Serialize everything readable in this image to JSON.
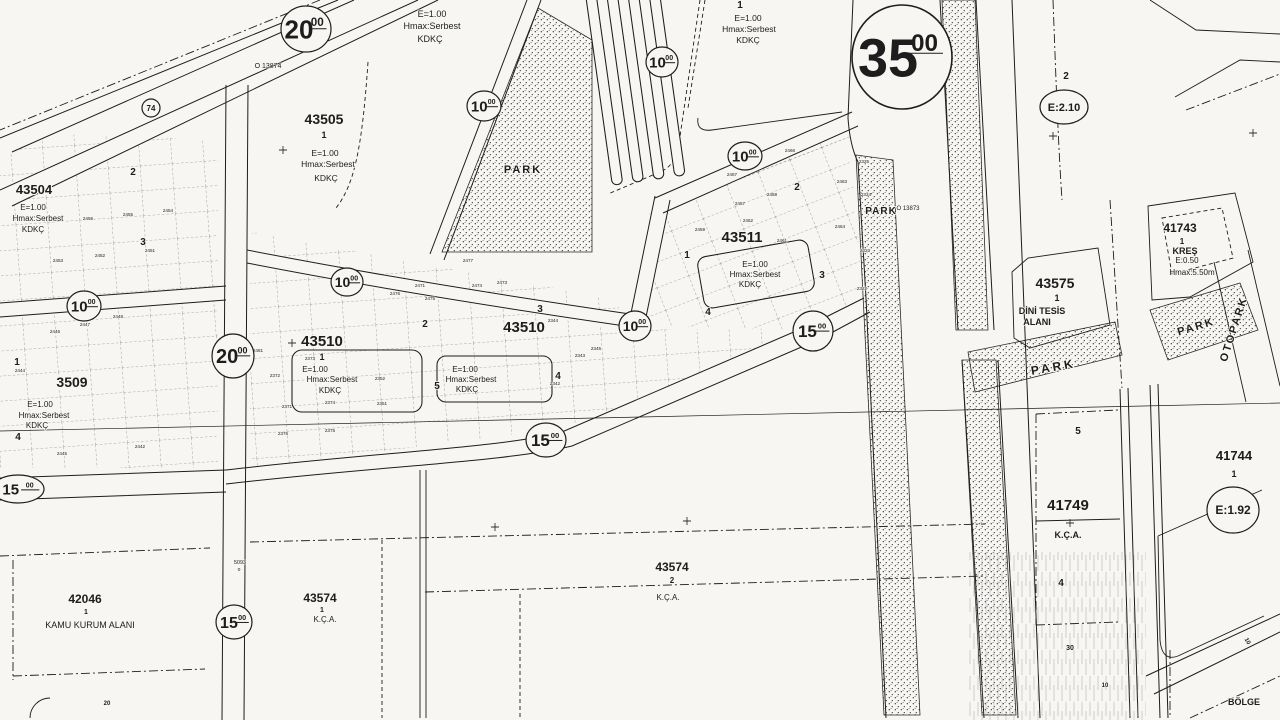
{
  "map": {
    "colors": {
      "paper": "#f7f6f3",
      "ink": "#1d1d1d",
      "faint": "#555555"
    },
    "labels": [
      {
        "t": "43505",
        "x": 324,
        "y": 124,
        "fs": 14,
        "w": 1
      },
      {
        "t": "1",
        "x": 324,
        "y": 138,
        "fs": 9,
        "w": 1
      },
      {
        "t": "E=1.00",
        "x": 325,
        "y": 156,
        "fs": 8.5
      },
      {
        "t": "Hmax:Serbest",
        "x": 328,
        "y": 167,
        "fs": 8.5
      },
      {
        "t": "KDKÇ",
        "x": 326,
        "y": 181,
        "fs": 8.5
      },
      {
        "t": "E=1.00",
        "x": 432,
        "y": 17,
        "fs": 9
      },
      {
        "t": "Hmax:Serbest",
        "x": 432,
        "y": 29,
        "fs": 9
      },
      {
        "t": "KDKÇ",
        "x": 430,
        "y": 42,
        "fs": 9
      },
      {
        "t": "E=1.00",
        "x": 748,
        "y": 21,
        "fs": 8.5
      },
      {
        "t": "Hmax:Serbest",
        "x": 749,
        "y": 32,
        "fs": 8.5
      },
      {
        "t": "KDKÇ",
        "x": 748,
        "y": 43,
        "fs": 8.5
      },
      {
        "t": "43504",
        "x": 34,
        "y": 194,
        "fs": 13,
        "w": 1
      },
      {
        "t": "E=1.00",
        "x": 33,
        "y": 210,
        "fs": 8
      },
      {
        "t": "Hmax:Serbest",
        "x": 38,
        "y": 221,
        "fs": 8
      },
      {
        "t": "KDKÇ",
        "x": 33,
        "y": 232,
        "fs": 8
      },
      {
        "t": "3509",
        "x": 72,
        "y": 387,
        "fs": 14,
        "w": 1
      },
      {
        "t": "E=1.00",
        "x": 40,
        "y": 407,
        "fs": 8
      },
      {
        "t": "Hmax:Serbest",
        "x": 44,
        "y": 418,
        "fs": 8
      },
      {
        "t": "KDKÇ",
        "x": 37,
        "y": 428,
        "fs": 8
      },
      {
        "t": "43510",
        "x": 322,
        "y": 346,
        "fs": 15,
        "w": 1
      },
      {
        "t": "1",
        "x": 322,
        "y": 360,
        "fs": 9,
        "w": 1
      },
      {
        "t": "E=1.00",
        "x": 315,
        "y": 372,
        "fs": 8
      },
      {
        "t": "Hmax:Serbest",
        "x": 332,
        "y": 382,
        "fs": 8
      },
      {
        "t": "KDKÇ",
        "x": 330,
        "y": 393,
        "fs": 8
      },
      {
        "t": "43510",
        "x": 524,
        "y": 332,
        "fs": 15,
        "w": 1
      },
      {
        "t": "E=1.00",
        "x": 465,
        "y": 372,
        "fs": 8
      },
      {
        "t": "Hmax:Serbest",
        "x": 471,
        "y": 382,
        "fs": 8
      },
      {
        "t": "KDKÇ",
        "x": 467,
        "y": 392,
        "fs": 8
      },
      {
        "t": "43511",
        "x": 742,
        "y": 242,
        "fs": 15,
        "w": 1
      },
      {
        "t": "E=1.00",
        "x": 755,
        "y": 267,
        "fs": 8
      },
      {
        "t": "Hmax:Serbest",
        "x": 755,
        "y": 277,
        "fs": 8
      },
      {
        "t": "KDKÇ",
        "x": 750,
        "y": 287,
        "fs": 8
      },
      {
        "t": "43575",
        "x": 1055,
        "y": 288,
        "fs": 14,
        "w": 1
      },
      {
        "t": "1",
        "x": 1057,
        "y": 301,
        "fs": 9,
        "w": 1
      },
      {
        "t": "DİNİ TESİS",
        "x": 1042,
        "y": 314,
        "fs": 9,
        "w": 1
      },
      {
        "t": "ALANI",
        "x": 1037,
        "y": 325,
        "fs": 9,
        "w": 1
      },
      {
        "t": "PARK",
        "x": 1054,
        "y": 371,
        "fs": 12,
        "w": 1,
        "ls": 3,
        "rot": -10
      },
      {
        "t": "PARK",
        "x": 881,
        "y": 214,
        "fs": 10,
        "w": 1,
        "ls": 1
      },
      {
        "t": "PARK",
        "x": 523,
        "y": 173,
        "fs": 11,
        "w": 1,
        "ls": 2
      },
      {
        "t": "PARK",
        "x": 1197,
        "y": 330,
        "fs": 11,
        "w": 1,
        "ls": 2,
        "rot": -17
      },
      {
        "t": "41743",
        "x": 1180,
        "y": 232,
        "fs": 12,
        "w": 1
      },
      {
        "t": "1",
        "x": 1182,
        "y": 244,
        "fs": 8,
        "w": 1
      },
      {
        "t": "KREŞ",
        "x": 1185,
        "y": 254,
        "fs": 9,
        "w": 1
      },
      {
        "t": "E:0.50",
        "x": 1187,
        "y": 263,
        "fs": 8
      },
      {
        "t": "Hmax:5.50m",
        "x": 1192,
        "y": 275,
        "fs": 8
      },
      {
        "t": "OTOPARK",
        "x": 1237,
        "y": 330,
        "fs": 11,
        "w": 1,
        "ls": 2,
        "rot": -72
      },
      {
        "t": "41744",
        "x": 1234,
        "y": 460,
        "fs": 13,
        "w": 1
      },
      {
        "t": "1",
        "x": 1234,
        "y": 477,
        "fs": 9,
        "w": 1
      },
      {
        "t": "41749",
        "x": 1068,
        "y": 510,
        "fs": 15,
        "w": 1
      },
      {
        "t": "K.Ç.A.",
        "x": 1068,
        "y": 538,
        "fs": 9,
        "w": 1
      },
      {
        "t": "43574",
        "x": 320,
        "y": 602,
        "fs": 12,
        "w": 1
      },
      {
        "t": "1",
        "x": 322,
        "y": 612,
        "fs": 7,
        "w": 1
      },
      {
        "t": "K.Ç.A.",
        "x": 325,
        "y": 622,
        "fs": 8
      },
      {
        "t": "43574",
        "x": 672,
        "y": 571,
        "fs": 12,
        "w": 1
      },
      {
        "t": "2",
        "x": 672,
        "y": 583,
        "fs": 8,
        "w": 1
      },
      {
        "t": "K.Ç.A.",
        "x": 668,
        "y": 600,
        "fs": 8
      },
      {
        "t": "42046",
        "x": 85,
        "y": 603,
        "fs": 12,
        "w": 1
      },
      {
        "t": "1",
        "x": 86,
        "y": 614,
        "fs": 7,
        "w": 1
      },
      {
        "t": "KAMU KURUM ALANI",
        "x": 90,
        "y": 628,
        "fs": 9
      },
      {
        "t": "2",
        "x": 1066,
        "y": 79,
        "fs": 10,
        "w": 1
      },
      {
        "t": "BÖLGE",
        "x": 1244,
        "y": 705,
        "fs": 9,
        "w": 1
      },
      {
        "t": "O 13874",
        "x": 268,
        "y": 68,
        "fs": 7
      },
      {
        "t": "O 13873",
        "x": 908,
        "y": 210,
        "fs": 6
      },
      {
        "t": "5093",
        "x": 240,
        "y": 564,
        "fs": 5.5
      },
      {
        "t": "o",
        "x": 239,
        "y": 571,
        "fs": 5
      }
    ],
    "sub_numbers": [
      {
        "t": "1",
        "x": 687,
        "y": 258
      },
      {
        "t": "2",
        "x": 797,
        "y": 190
      },
      {
        "t": "3",
        "x": 822,
        "y": 278
      },
      {
        "t": "4",
        "x": 708,
        "y": 315
      },
      {
        "t": "2",
        "x": 425,
        "y": 327
      },
      {
        "t": "3",
        "x": 540,
        "y": 312
      },
      {
        "t": "4",
        "x": 558,
        "y": 379
      },
      {
        "t": "5",
        "x": 437,
        "y": 389
      },
      {
        "t": "2",
        "x": 133,
        "y": 175
      },
      {
        "t": "3",
        "x": 143,
        "y": 245
      },
      {
        "t": "1",
        "x": 17,
        "y": 365
      },
      {
        "t": "4",
        "x": 18,
        "y": 440
      },
      {
        "t": "5",
        "x": 1078,
        "y": 434
      },
      {
        "t": "4",
        "x": 1061,
        "y": 586
      },
      {
        "t": "1",
        "x": 740,
        "y": 8
      },
      {
        "t": "30",
        "x": 1070,
        "y": 650,
        "fs": 7
      },
      {
        "t": "10",
        "x": 1105,
        "y": 687,
        "fs": 6
      },
      {
        "t": "10",
        "x": 1246,
        "y": 642,
        "fs": 6,
        "rot": 60
      },
      {
        "t": "20",
        "x": 107,
        "y": 705,
        "fs": 6
      }
    ],
    "parcel_numbers": [
      {
        "t": "2444",
        "x": 20,
        "y": 372
      },
      {
        "t": "2446",
        "x": 55,
        "y": 333
      },
      {
        "t": "2447",
        "x": 85,
        "y": 326
      },
      {
        "t": "2448",
        "x": 118,
        "y": 318
      },
      {
        "t": "2451",
        "x": 150,
        "y": 252
      },
      {
        "t": "2452",
        "x": 100,
        "y": 257
      },
      {
        "t": "2453",
        "x": 58,
        "y": 262
      },
      {
        "t": "2454",
        "x": 168,
        "y": 212
      },
      {
        "t": "2455",
        "x": 128,
        "y": 216
      },
      {
        "t": "2456",
        "x": 88,
        "y": 220
      },
      {
        "t": "2445",
        "x": 62,
        "y": 455
      },
      {
        "t": "2442",
        "x": 140,
        "y": 448
      },
      {
        "t": "2457",
        "x": 740,
        "y": 205
      },
      {
        "t": "2458",
        "x": 772,
        "y": 196
      },
      {
        "t": "2459",
        "x": 700,
        "y": 231
      },
      {
        "t": "2461",
        "x": 782,
        "y": 242
      },
      {
        "t": "2462",
        "x": 748,
        "y": 222
      },
      {
        "t": "2463",
        "x": 842,
        "y": 183
      },
      {
        "t": "2464",
        "x": 840,
        "y": 228
      },
      {
        "t": "2466",
        "x": 790,
        "y": 152
      },
      {
        "t": "2467",
        "x": 732,
        "y": 176
      },
      {
        "t": "2322",
        "x": 862,
        "y": 290
      },
      {
        "t": "2323",
        "x": 865,
        "y": 252
      },
      {
        "t": "2324",
        "x": 866,
        "y": 196
      },
      {
        "t": "2325",
        "x": 864,
        "y": 163
      },
      {
        "t": "2342",
        "x": 555,
        "y": 385
      },
      {
        "t": "2343",
        "x": 580,
        "y": 357
      },
      {
        "t": "2344",
        "x": 553,
        "y": 322
      },
      {
        "t": "2345",
        "x": 596,
        "y": 350
      },
      {
        "t": "2351",
        "x": 382,
        "y": 405
      },
      {
        "t": "2352",
        "x": 380,
        "y": 380
      },
      {
        "t": "2371",
        "x": 287,
        "y": 408
      },
      {
        "t": "2372",
        "x": 275,
        "y": 377
      },
      {
        "t": "2373",
        "x": 310,
        "y": 360
      },
      {
        "t": "2374",
        "x": 330,
        "y": 404
      },
      {
        "t": "2375",
        "x": 330,
        "y": 432
      },
      {
        "t": "2376",
        "x": 283,
        "y": 435
      },
      {
        "t": "2471",
        "x": 420,
        "y": 287
      },
      {
        "t": "2472",
        "x": 350,
        "y": 283
      },
      {
        "t": "2473",
        "x": 502,
        "y": 284
      },
      {
        "t": "2474",
        "x": 477,
        "y": 287
      },
      {
        "t": "2477",
        "x": 468,
        "y": 262
      },
      {
        "t": "2481",
        "x": 258,
        "y": 352
      },
      {
        "t": "2475",
        "x": 430,
        "y": 300
      },
      {
        "t": "2476",
        "x": 395,
        "y": 295
      }
    ],
    "road_circles": [
      {
        "x": 306,
        "y": 29,
        "rx": 25,
        "ry": 23,
        "main": "20",
        "sup": "00",
        "fs": 26
      },
      {
        "x": 151,
        "y": 108,
        "rx": 9,
        "ry": 9,
        "main": "74",
        "sup": "",
        "fs": 8
      },
      {
        "x": 902,
        "y": 57,
        "rx": 50,
        "ry": 52,
        "main": "35",
        "sup": "00",
        "fs": 54
      },
      {
        "x": 484,
        "y": 106,
        "rx": 17,
        "ry": 15,
        "main": "10",
        "sup": "00",
        "fs": 15
      },
      {
        "x": 662,
        "y": 62,
        "rx": 16,
        "ry": 15,
        "main": "10",
        "sup": "00",
        "fs": 15
      },
      {
        "x": 745,
        "y": 156,
        "rx": 17,
        "ry": 14,
        "main": "10",
        "sup": "00",
        "fs": 15
      },
      {
        "x": 84,
        "y": 306,
        "rx": 17,
        "ry": 15,
        "main": "10",
        "sup": "00",
        "fs": 15
      },
      {
        "x": 347,
        "y": 282,
        "rx": 16,
        "ry": 14,
        "main": "10",
        "sup": "00",
        "fs": 14
      },
      {
        "x": 635,
        "y": 326,
        "rx": 16,
        "ry": 15,
        "main": "10",
        "sup": "00",
        "fs": 14
      },
      {
        "x": 233,
        "y": 356,
        "rx": 21,
        "ry": 22,
        "main": "20",
        "sup": "00",
        "fs": 20
      },
      {
        "x": 546,
        "y": 440,
        "rx": 20,
        "ry": 17,
        "main": "15",
        "sup": "00",
        "fs": 17
      },
      {
        "x": 813,
        "y": 331,
        "rx": 20,
        "ry": 20,
        "main": "15",
        "sup": "00",
        "fs": 17
      },
      {
        "x": 18,
        "y": 489,
        "rx": 26,
        "ry": 14,
        "main": "15",
        "sup": "00",
        "fs": 15
      },
      {
        "x": 234,
        "y": 622,
        "rx": 18,
        "ry": 17,
        "main": "15",
        "sup": "00",
        "fs": 16
      },
      {
        "x": 1064,
        "y": 107,
        "rx": 24,
        "ry": 17,
        "main": "E:2.10",
        "sup": "",
        "fs": 11
      },
      {
        "x": 1233,
        "y": 510,
        "rx": 26,
        "ry": 23,
        "main": "E:1.92",
        "sup": "",
        "fs": 12
      }
    ],
    "plus_marks": [
      [
        283,
        150
      ],
      [
        292,
        343
      ],
      [
        1053,
        136
      ],
      [
        1253,
        133
      ],
      [
        1070,
        523
      ],
      [
        495,
        527
      ],
      [
        687,
        521
      ]
    ]
  }
}
